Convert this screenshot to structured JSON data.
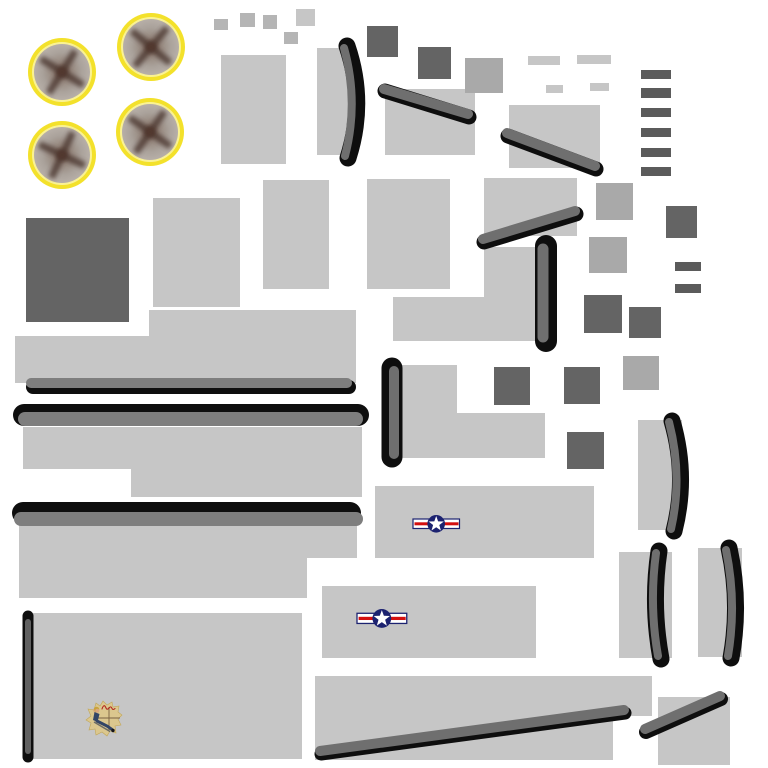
{
  "meta": {
    "kind": "aircraft-texture-atlas",
    "canvas": {
      "width": 768,
      "height": 768
    },
    "background": "#ffffff"
  },
  "palette": {
    "light": "#c6c6c6",
    "small_sq": "#b5b5b5",
    "medium": "#a9a9a9",
    "dark": "#646464",
    "dash_dark": "#5b5b5b",
    "strip_gray": "#6f6f6f",
    "bar_gray": "#7e7e7e",
    "thin_gray": "#616161",
    "black": "#0e0e0e",
    "ring_yellow": "#f3e12b",
    "ring_pale": "#faf294",
    "disc_core": "#6b5047",
    "disc_mid": "#97897f",
    "disc_light": "#aaa29b",
    "disc_edge": "#b7afa8",
    "blade": "#4a362f",
    "hub": "#51392f",
    "navy": "#1c2270",
    "red": "#d40f0f",
    "white": "#ffffff",
    "cream": "#dbc78e",
    "cream_edge": "#c2a757",
    "skin": "#d9a77e",
    "hair": "#c9a33b",
    "uniform": "#334566",
    "script_red": "#b3261e",
    "cross_brown": "#70583a"
  },
  "shapes": {
    "rects": [
      {
        "name": "panel",
        "x": 221,
        "y": 55,
        "w": 65,
        "h": 109,
        "fill": "light"
      },
      {
        "name": "panel",
        "x": 317,
        "y": 48,
        "w": 38,
        "h": 107,
        "fill": "light"
      },
      {
        "name": "panel",
        "x": 385,
        "y": 89,
        "w": 90,
        "h": 66,
        "fill": "light"
      },
      {
        "name": "panel",
        "x": 509,
        "y": 105,
        "w": 91,
        "h": 63,
        "fill": "light"
      },
      {
        "name": "panel",
        "x": 484,
        "y": 178,
        "w": 93,
        "h": 58,
        "fill": "light"
      },
      {
        "name": "panel",
        "x": 153,
        "y": 198,
        "w": 87,
        "h": 109,
        "fill": "light"
      },
      {
        "name": "panel",
        "x": 263,
        "y": 180,
        "w": 66,
        "h": 109,
        "fill": "light"
      },
      {
        "name": "panel",
        "x": 367,
        "y": 179,
        "w": 83,
        "h": 110,
        "fill": "light"
      },
      {
        "name": "panel",
        "x": 149,
        "y": 310,
        "w": 207,
        "h": 27,
        "fill": "light"
      },
      {
        "name": "panel",
        "x": 15,
        "y": 336,
        "w": 341,
        "h": 47,
        "fill": "light"
      },
      {
        "name": "panel",
        "x": 23,
        "y": 427,
        "w": 339,
        "h": 42,
        "fill": "light"
      },
      {
        "name": "panel",
        "x": 131,
        "y": 469,
        "w": 231,
        "h": 28,
        "fill": "light"
      },
      {
        "name": "panel",
        "x": 19,
        "y": 525,
        "w": 338,
        "h": 33,
        "fill": "light"
      },
      {
        "name": "panel",
        "x": 19,
        "y": 558,
        "w": 288,
        "h": 40,
        "fill": "light"
      },
      {
        "name": "fuselage-panel-roundel",
        "x": 375,
        "y": 486,
        "w": 219,
        "h": 72,
        "fill": "light"
      },
      {
        "name": "panel",
        "x": 484,
        "y": 247,
        "w": 56,
        "h": 94,
        "fill": "light"
      },
      {
        "name": "panel",
        "x": 393,
        "y": 297,
        "w": 91,
        "h": 44,
        "fill": "light"
      },
      {
        "name": "panel",
        "x": 389,
        "y": 365,
        "w": 68,
        "h": 48,
        "fill": "light"
      },
      {
        "name": "panel",
        "x": 389,
        "y": 413,
        "w": 156,
        "h": 45,
        "fill": "light"
      },
      {
        "name": "fuselage-panel-roundel",
        "x": 322,
        "y": 586,
        "w": 214,
        "h": 72,
        "fill": "light"
      },
      {
        "name": "nose-art-panel",
        "x": 33,
        "y": 613,
        "w": 269,
        "h": 146,
        "fill": "light"
      },
      {
        "name": "panel",
        "x": 315,
        "y": 676,
        "w": 337,
        "h": 40,
        "fill": "light"
      },
      {
        "name": "panel",
        "x": 315,
        "y": 716,
        "w": 298,
        "h": 44,
        "fill": "light"
      },
      {
        "name": "panel",
        "x": 638,
        "y": 420,
        "w": 44,
        "h": 110,
        "fill": "light"
      },
      {
        "name": "panel",
        "x": 619,
        "y": 552,
        "w": 53,
        "h": 106,
        "fill": "light"
      },
      {
        "name": "panel",
        "x": 698,
        "y": 548,
        "w": 44,
        "h": 109,
        "fill": "light"
      },
      {
        "name": "panel",
        "x": 658,
        "y": 697,
        "w": 72,
        "h": 68,
        "fill": "light"
      },
      {
        "name": "small-square",
        "x": 296,
        "y": 9,
        "w": 19,
        "h": 17,
        "fill": "light"
      },
      {
        "name": "small-square",
        "x": 284,
        "y": 32,
        "w": 14,
        "h": 12,
        "fill": "small_sq"
      },
      {
        "name": "small-square",
        "x": 214,
        "y": 19,
        "w": 14,
        "h": 11,
        "fill": "small_sq"
      },
      {
        "name": "small-square",
        "x": 240,
        "y": 13,
        "w": 15,
        "h": 14,
        "fill": "small_sq"
      },
      {
        "name": "small-square",
        "x": 263,
        "y": 15,
        "w": 14,
        "h": 14,
        "fill": "small_sq"
      },
      {
        "name": "light-dash",
        "x": 528,
        "y": 56,
        "w": 32,
        "h": 9,
        "fill": "light"
      },
      {
        "name": "light-dash",
        "x": 577,
        "y": 55,
        "w": 34,
        "h": 9,
        "fill": "light"
      },
      {
        "name": "light-dash",
        "x": 546,
        "y": 85,
        "w": 17,
        "h": 8,
        "fill": "light"
      },
      {
        "name": "light-dash",
        "x": 590,
        "y": 83,
        "w": 19,
        "h": 8,
        "fill": "light"
      },
      {
        "name": "medium-square",
        "x": 465,
        "y": 58,
        "w": 38,
        "h": 35,
        "fill": "medium"
      },
      {
        "name": "medium-square",
        "x": 596,
        "y": 183,
        "w": 37,
        "h": 37,
        "fill": "medium"
      },
      {
        "name": "medium-square",
        "x": 589,
        "y": 237,
        "w": 38,
        "h": 36,
        "fill": "medium"
      },
      {
        "name": "medium-square",
        "x": 623,
        "y": 356,
        "w": 36,
        "h": 34,
        "fill": "medium"
      },
      {
        "name": "dark-square",
        "x": 367,
        "y": 26,
        "w": 31,
        "h": 31,
        "fill": "dark"
      },
      {
        "name": "dark-square",
        "x": 418,
        "y": 47,
        "w": 33,
        "h": 32,
        "fill": "dark"
      },
      {
        "name": "dark-square-large",
        "x": 26,
        "y": 218,
        "w": 103,
        "h": 104,
        "fill": "dark"
      },
      {
        "name": "dark-square",
        "x": 666,
        "y": 206,
        "w": 31,
        "h": 32,
        "fill": "dark"
      },
      {
        "name": "dark-square",
        "x": 584,
        "y": 295,
        "w": 38,
        "h": 38,
        "fill": "dark"
      },
      {
        "name": "dark-square",
        "x": 629,
        "y": 307,
        "w": 32,
        "h": 31,
        "fill": "dark"
      },
      {
        "name": "dark-square",
        "x": 494,
        "y": 367,
        "w": 36,
        "h": 38,
        "fill": "dark"
      },
      {
        "name": "dark-square",
        "x": 564,
        "y": 367,
        "w": 36,
        "h": 37,
        "fill": "dark"
      },
      {
        "name": "dark-square",
        "x": 567,
        "y": 432,
        "w": 37,
        "h": 37,
        "fill": "dark"
      },
      {
        "name": "dark-dash",
        "x": 641,
        "y": 70,
        "w": 30,
        "h": 9,
        "fill": "dash_dark"
      },
      {
        "name": "dark-dash",
        "x": 641,
        "y": 88,
        "w": 30,
        "h": 10,
        "fill": "dash_dark"
      },
      {
        "name": "dark-dash",
        "x": 641,
        "y": 108,
        "w": 30,
        "h": 9,
        "fill": "dash_dark"
      },
      {
        "name": "dark-dash",
        "x": 641,
        "y": 128,
        "w": 30,
        "h": 9,
        "fill": "dash_dark"
      },
      {
        "name": "dark-dash",
        "x": 641,
        "y": 148,
        "w": 30,
        "h": 9,
        "fill": "dash_dark"
      },
      {
        "name": "dark-dash",
        "x": 641,
        "y": 167,
        "w": 30,
        "h": 9,
        "fill": "dash_dark"
      },
      {
        "name": "dark-dash",
        "x": 675,
        "y": 262,
        "w": 26,
        "h": 9,
        "fill": "dash_dark"
      },
      {
        "name": "dark-dash",
        "x": 675,
        "y": 284,
        "w": 26,
        "h": 9,
        "fill": "dash_dark"
      }
    ],
    "strips": [
      {
        "name": "edge-strip-curved",
        "black": {
          "d": "M347,46 Q366,102 348,158",
          "w": 17
        },
        "gray": {
          "d": "M344,48 Q359,102 345,156",
          "w": 8
        }
      },
      {
        "name": "edge-strip-diagonal",
        "black": {
          "x1": 385,
          "y1": 91,
          "x2": 469,
          "y2": 117,
          "w": 15
        },
        "gray": {
          "x1": 384,
          "y1": 89,
          "x2": 468,
          "y2": 114,
          "w": 10
        }
      },
      {
        "name": "edge-strip-diagonal",
        "black": {
          "x1": 508,
          "y1": 136,
          "x2": 596,
          "y2": 169,
          "w": 15
        },
        "gray": {
          "x1": 507,
          "y1": 133,
          "x2": 595,
          "y2": 166,
          "w": 10
        }
      },
      {
        "name": "edge-strip-diagonal",
        "black": {
          "x1": 484,
          "y1": 242,
          "x2": 576,
          "y2": 214,
          "w": 15
        },
        "gray": {
          "x1": 483,
          "y1": 239,
          "x2": 575,
          "y2": 211,
          "w": 10
        }
      },
      {
        "name": "edge-strip-vertical",
        "black": {
          "x1": 546,
          "y1": 246,
          "x2": 546,
          "y2": 341,
          "w": 22
        },
        "gray": {
          "x1": 543,
          "y1": 249,
          "x2": 543,
          "y2": 337,
          "w": 11
        }
      },
      {
        "name": "edge-strip-vertical",
        "black": {
          "x1": 392,
          "y1": 368,
          "x2": 392,
          "y2": 457,
          "w": 21
        },
        "gray": {
          "x1": 394,
          "y1": 371,
          "x2": 394,
          "y2": 454,
          "w": 10
        }
      },
      {
        "name": "edge-bar-horizontal",
        "black": {
          "x1": 33,
          "y1": 387,
          "x2": 349,
          "y2": 387,
          "w": 14
        },
        "gray": {
          "x1": 31,
          "y1": 383,
          "x2": 347,
          "y2": 383,
          "w": 10,
          "color": "bar_gray"
        }
      },
      {
        "name": "edge-bar-horizontal",
        "black": {
          "x1": 24,
          "y1": 415,
          "x2": 358,
          "y2": 415,
          "w": 22
        },
        "gray": {
          "x1": 25,
          "y1": 419,
          "x2": 356,
          "y2": 419,
          "w": 14,
          "color": "bar_gray"
        }
      },
      {
        "name": "edge-bar-horizontal",
        "black": {
          "x1": 23,
          "y1": 513,
          "x2": 350,
          "y2": 513,
          "w": 22
        },
        "gray": {
          "x1": 21,
          "y1": 519,
          "x2": 356,
          "y2": 519,
          "w": 14,
          "color": "bar_gray"
        }
      },
      {
        "name": "thin-strip-vertical",
        "black": {
          "x1": 28,
          "y1": 616,
          "x2": 28,
          "y2": 757,
          "w": 11
        },
        "gray": {
          "x1": 28,
          "y1": 622,
          "x2": 28,
          "y2": 751,
          "w": 6,
          "color": "thin_gray"
        }
      },
      {
        "name": "edge-strip-curved",
        "black": {
          "d": "M672,421 Q688,476 674,531",
          "w": 17
        },
        "gray": {
          "d": "M669,422 Q683,476 671,529",
          "w": 8
        }
      },
      {
        "name": "edge-strip-curved",
        "black": {
          "d": "M659,551 Q651,605 661,659",
          "w": 17
        },
        "gray": {
          "d": "M656,553 Q649,605 658,656",
          "w": 8
        }
      },
      {
        "name": "edge-strip-curved",
        "black": {
          "d": "M729,548 Q741,603 731,658",
          "w": 17
        },
        "gray": {
          "d": "M726,550 Q737,603 728,656",
          "w": 8
        }
      },
      {
        "name": "edge-strip-long-diagonal",
        "black": {
          "x1": 321,
          "y1": 754,
          "x2": 625,
          "y2": 713,
          "w": 13
        },
        "gray": {
          "x1": 320,
          "y1": 751,
          "x2": 624,
          "y2": 710,
          "w": 10
        }
      },
      {
        "name": "edge-strip-diagonal",
        "black": {
          "x1": 646,
          "y1": 732,
          "x2": 721,
          "y2": 699,
          "w": 14
        },
        "gray": {
          "x1": 645,
          "y1": 729,
          "x2": 720,
          "y2": 696,
          "w": 10
        }
      }
    ],
    "wheels": {
      "r": 34,
      "blade_angles": [
        32,
        40,
        25,
        35
      ],
      "centers": [
        {
          "cx": 62,
          "cy": 72
        },
        {
          "cx": 151,
          "cy": 47
        },
        {
          "cx": 62,
          "cy": 155
        },
        {
          "cx": 150,
          "cy": 132
        }
      ]
    },
    "roundels": [
      {
        "x": 413,
        "y": 515,
        "scale": 1.0
      },
      {
        "x": 357,
        "y": 609,
        "scale": 1.07
      }
    ],
    "pinup": {
      "x": 85,
      "y": 700,
      "w": 37,
      "h": 37
    }
  }
}
